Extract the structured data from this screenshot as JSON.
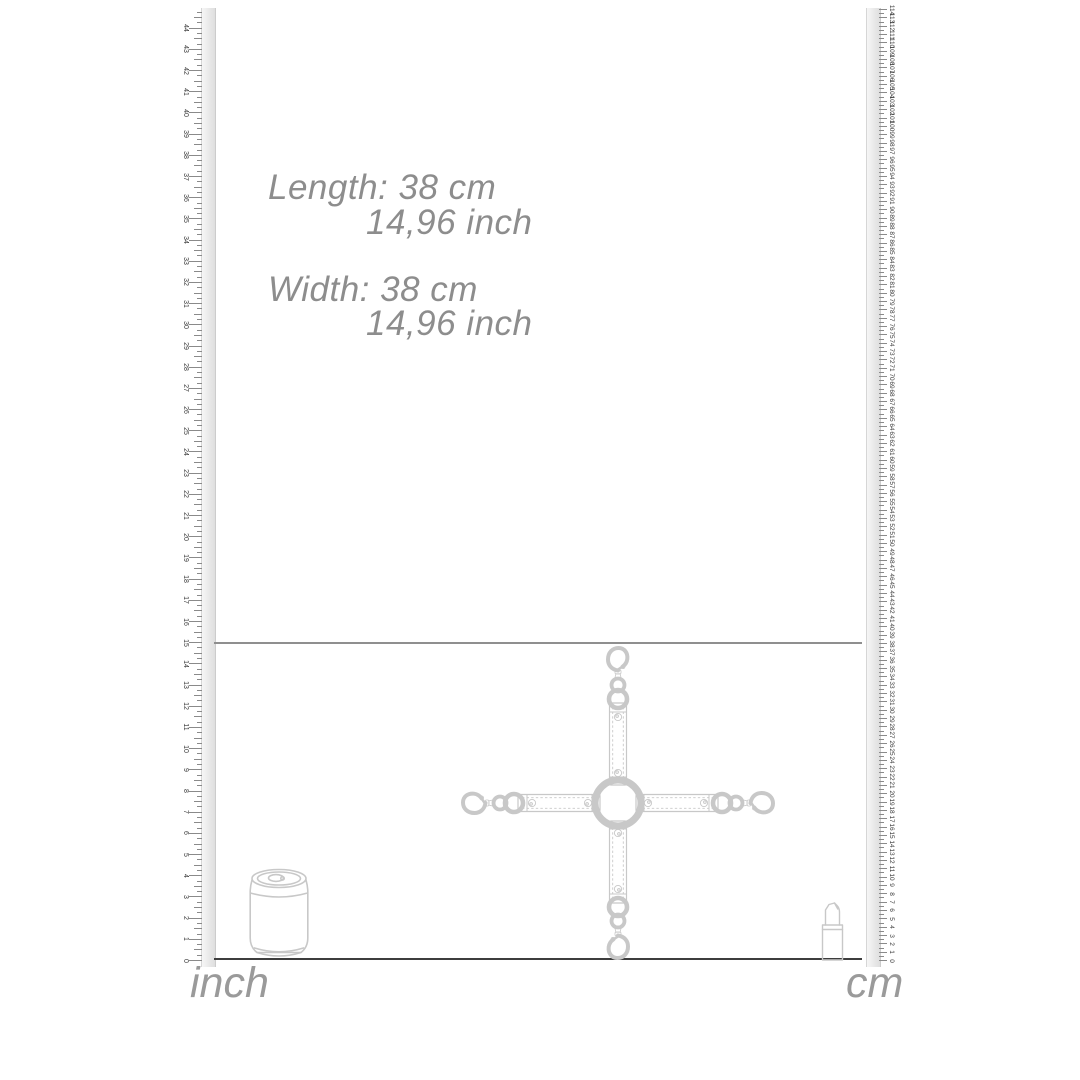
{
  "dimension_text": {
    "length_label": "Length:",
    "length_metric": "38 cm",
    "length_imperial": "14,96 inch",
    "width_label": "Width:",
    "width_metric": "38 cm",
    "width_imperial": "14,96 inch"
  },
  "rulers": {
    "left": {
      "unit": "inch",
      "min": 0,
      "max": 44
    },
    "right": {
      "unit": "cm",
      "min": 0,
      "max": 113
    }
  },
  "product": {
    "name": "hogtie-cross-strap",
    "length_cm": 38,
    "width_cm": 38
  },
  "colors": {
    "strap": "#26656c",
    "strap_dark": "#163f45",
    "strap_fold": "#1d545b",
    "stitch": "#4d9098",
    "gold": "#d3a377",
    "gold_light": "#eed2ae",
    "gold_dark": "#a87a4e",
    "rivet": "#dfc49e",
    "guide_line": "#8f8f8f",
    "baseline": "#3d3d3d",
    "annotation_text": "#8d8d8d",
    "tick": "#8a8a8a",
    "tick_label": "#3a3a3a",
    "outline": "#c8c8c8"
  }
}
